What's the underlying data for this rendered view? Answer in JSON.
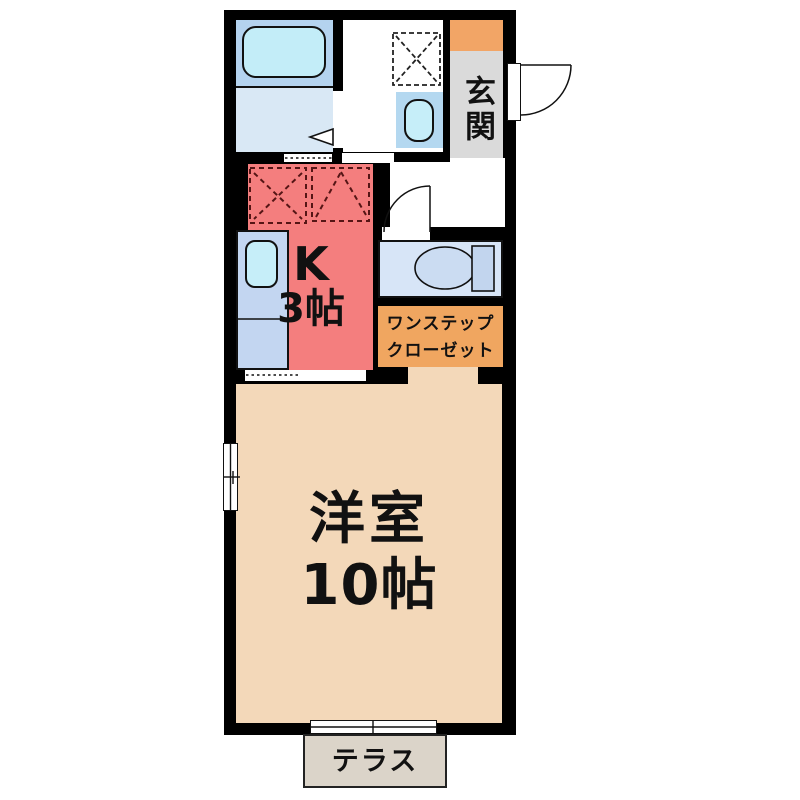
{
  "floorplan": {
    "labels": {
      "entrance": "玄関",
      "kitchen_type": "K",
      "kitchen_size": "3帖",
      "closet_line1": "ワンステップ",
      "closet_line2": "クローゼット",
      "room_name": "洋室",
      "room_size": "10帖",
      "terrace": "テラス"
    },
    "rooms": [
      {
        "name": "玄関",
        "type": "entrance"
      },
      {
        "name": "K 3帖",
        "type": "kitchen"
      },
      {
        "name": "ワンステップクローゼット",
        "type": "closet"
      },
      {
        "name": "洋室 10帖",
        "type": "western-room"
      },
      {
        "name": "テラス",
        "type": "terrace"
      }
    ],
    "fixtures": [
      "bathtub",
      "washing-machine-pan",
      "washbasin",
      "kitchen-sink",
      "stove-space",
      "toilet",
      "door-swing",
      "folding-door-arrow",
      "window",
      "sliding-door"
    ],
    "colors": {
      "wall": "#000000",
      "kitchen": "#f47e7e",
      "western_room": "#f3d8b9",
      "bathroom_upper": "#b4d3ef",
      "bathroom_lower": "#d9e8f5",
      "bathtub": "#c3edf8",
      "washbasin_unit": "#b4d8f0",
      "basin": "#c6eef9",
      "counter": "#c3d6f1",
      "toilet_room": "#d7e5f7",
      "entrance_step": "#f2a566",
      "entrance_floor": "#dadada",
      "closet": "#f0a660",
      "terrace": "#dbd4c9"
    }
  }
}
